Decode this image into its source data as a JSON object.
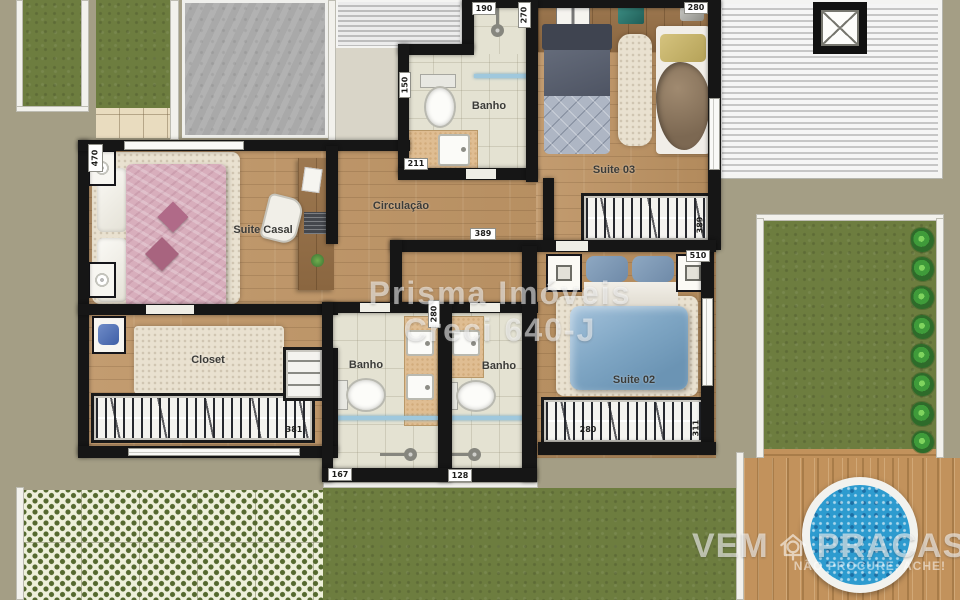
{
  "watermark": {
    "line1": "Prisma Imóveis",
    "line2": "Creci 640-J"
  },
  "brand": {
    "word1": "VEM",
    "word2": "PRACASA",
    "tagline": "NÃO PROCURE, ACHE!"
  },
  "rooms": {
    "suite_casal": "Suite Casal",
    "closet": "Closet",
    "circulacao": "Circulação",
    "banho_superior": "Banho",
    "banho_esquerdo": "Banho",
    "banho_direito": "Banho",
    "suite_03": "Suite 03",
    "suite_02": "Suite 02"
  },
  "dimensions": {
    "d190": "190",
    "d270": "270",
    "d150": "150",
    "d211": "211",
    "d280_suite03": "280",
    "d470": "470",
    "d389_circ": "389",
    "d389_wardrobe": "389",
    "d510": "510",
    "d280_banho": "280",
    "d381": "381",
    "d167": "167",
    "d128": "128",
    "d280_wardrobe": "280",
    "d311": "311"
  },
  "colors": {
    "background": "#a49e85",
    "wall": "#161616",
    "wood_floor": "#bd9569",
    "bath_floor": "#e4e2d2",
    "grass": "#6d7d3f",
    "pool_water": "#2d9bcf",
    "deck": "#b3824c",
    "bed_pink": "#d8aebc",
    "bed_blue": "#7fa6c4",
    "bed_gray": "#aeb6c4",
    "watermark": "rgba(255,255,255,0.55)"
  }
}
